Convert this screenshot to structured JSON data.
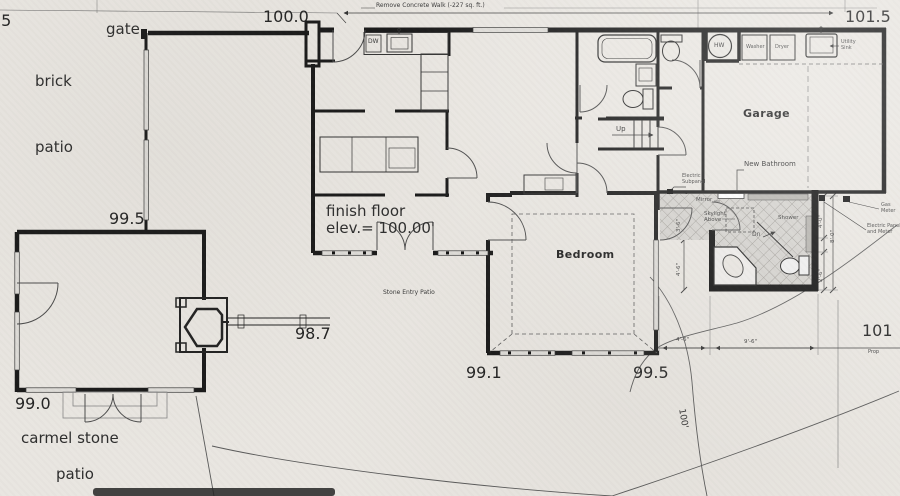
{
  "colors": {
    "paper": "#e9e6e1",
    "ink": "#1a1a1a",
    "thin_line": "#555555",
    "tile_bg": "#d4d2ce",
    "tile_line": "#97948f"
  },
  "site": {
    "partial_elevation": ".5",
    "gate": "gate",
    "brick": "brick",
    "patio_upper": "patio",
    "carmel_stone": "carmel stone",
    "patio_lower": "patio",
    "remove_walk_note": "Remove Concrete Walk (-227 sq. ft.)",
    "contour_label": "100'",
    "property_label": "Prop",
    "elev_gate_wall": "100.0",
    "elev_top_right": "101.5",
    "elev_living_top": "99.5",
    "elev_living_bottom": "99.0",
    "elev_entry": "98.7",
    "elev_bedroom_left": "99.1",
    "elev_bedroom_right": "99.5",
    "elev_right_edge": "101"
  },
  "rooms": {
    "bedroom": "Bedroom",
    "garage": "Garage",
    "finish_floor_line1": "finish floor",
    "finish_floor_line2": "elev.= 100.00'",
    "stone_entry_patio": "Stone Entry Patio"
  },
  "fixtures": {
    "dw": "DW",
    "hw": "HW",
    "washer": "Washer",
    "dryer": "Dryer",
    "utility_sink_line1": "Utility",
    "utility_sink_line2": "Sink",
    "up": "Up",
    "dn": "Dn"
  },
  "new_bathroom": {
    "title": "New Bathroom",
    "mirror": "Mirror",
    "skylight_line1": "Skylight",
    "skylight_line2": "Above",
    "shower": "Shower"
  },
  "utilities": {
    "electric_subpanel_line1": "Electric",
    "electric_subpanel_line2": "Subpanel",
    "gas_meter_line1": "Gas",
    "gas_meter_line2": "Meter",
    "electric_panel_line1": "Electric Panel",
    "electric_panel_line2": "and Meter"
  },
  "dimensions": {
    "bath_w_upper": "3'-6\"",
    "bath_w_lower": "4'-6\"",
    "bath_e_upper": "4'-0\"",
    "bath_e_full": "8'-0\"",
    "bath_e_lower": "2'-6\"",
    "bottom_left": "4'-6\"",
    "bottom_right": "9'-6\""
  }
}
